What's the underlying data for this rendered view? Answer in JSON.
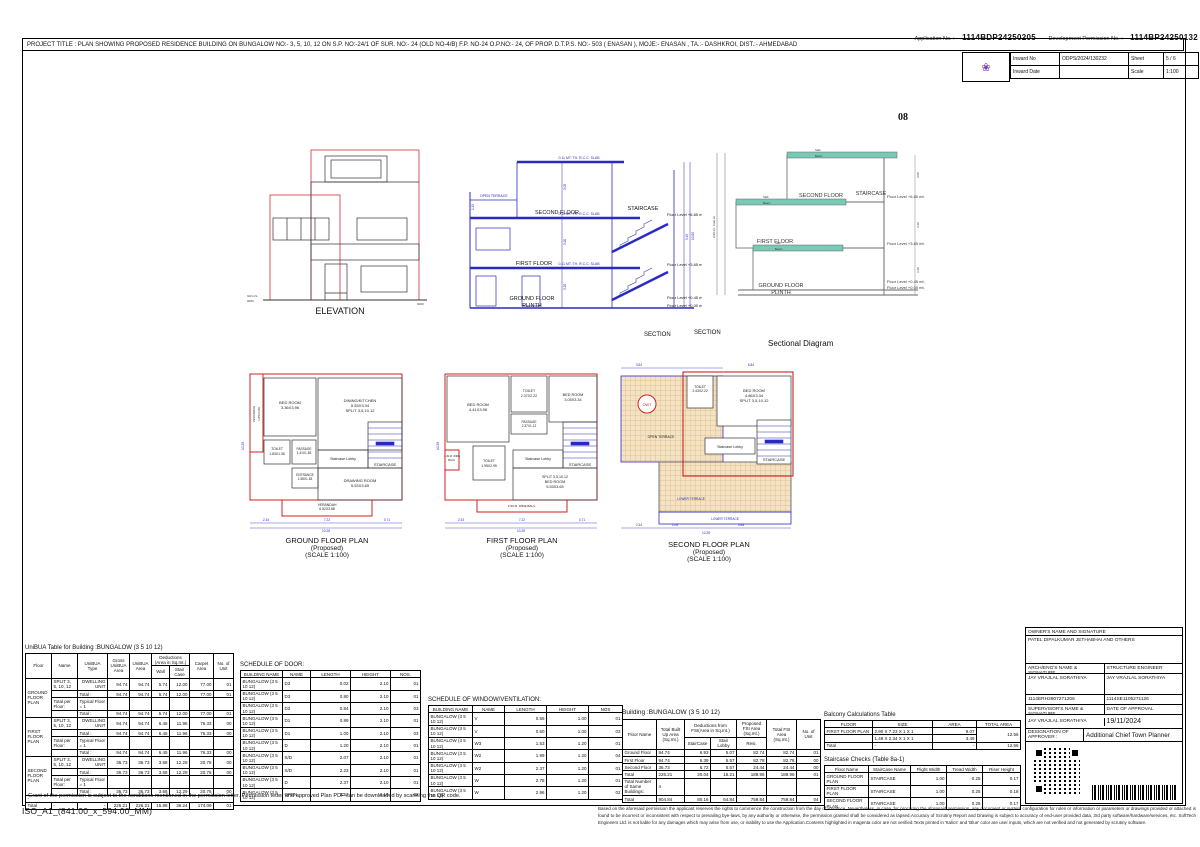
{
  "colors": {
    "plan_red": "#cc2222",
    "cad_blue": "#2a2ac0",
    "slab_teal": "#79c9b6",
    "terrace_tan": "#e7c491",
    "logo_purple": "#7b3fc4"
  },
  "header": {
    "app_no_label": "Application No. :",
    "app_no": "1114BDP24250205",
    "dev_no_label": "Development Permission No. :",
    "dev_no": "1114BP24250132",
    "project_title": "PROJECT TITLE : PLAN SHOWING PROPOSED RESIDENCE BUILDING ON BUNGALOW NO:- 3, 5, 10, 12 ON S.P. NO:-24/1 OF SUR. NO:- 24 (OLD NO-4/B) F.P. NO-24 O.P.NO:- 24, OF PROP. D.T.P.S. NO:- 503 ( ENASAN ), MOJE:- ENASAN , TA.:- DASHKROI, DIST.:- AHMEDABAD",
    "page_no": "08",
    "logo_glyph": "❀",
    "inward": {
      "inward_no_label": "Inward No",
      "inward_no": "ODPS/2024/130232",
      "sheet_label": "Sheet",
      "sheet": "5 / 6",
      "inward_date_label": "Inward Date",
      "inward_date": "",
      "scale_label": "Scale",
      "scale": "1:100"
    }
  },
  "drawings": {
    "elevation": {
      "caption": "ELEVATION",
      "gr_lvl": "GR.LVL.",
      "zero": "0000"
    },
    "section": {
      "caption": "SECTION",
      "slab_note": "0.11 MT. TH. R.C.C. SLAB",
      "open_terrace": "OPEN TERRACE",
      "second_floor": "SECOND FLOOR",
      "staircase": "STAIRCASE",
      "first_floor": "FIRST FLOOR",
      "ground_floor": "GROUND FLOOR",
      "plinth": "PLINTH",
      "lvl_685": "Floor Level +6.85 mt.",
      "lvl_365": "Floor Level +3.65 mt.",
      "lvl_045": "Floor Level +0.45 mt.",
      "lvl_000": "Floor Level +0.00 mt.",
      "dims": [
        "3.05",
        "3.20",
        "3.20",
        "1.15",
        "9.45",
        "10.60"
      ]
    },
    "sectional": {
      "caption_section": "SECTION",
      "caption": "Sectional Diagram",
      "slab": "Slab",
      "beam": "Beam",
      "total_ht": "9.90 mt. Total Ht.",
      "second_floor": "SECOND FLOOR",
      "staircase": "STAIRCASE",
      "first_floor": "FIRST FLOOR",
      "ground_floor": "GROUND FLOOR",
      "plinth": "PLINTH",
      "lvl_685": "Floor Level +6.85 mt.",
      "lvl_365": "Floor Level +3.65 mt.",
      "lvl_045": "Floor Level +0.45 mt.",
      "lvl_000": "Floor Level +0.00 mt.",
      "dims": [
        "3.00",
        "3.20",
        "3.20"
      ]
    }
  },
  "plans": {
    "ground": {
      "caption": [
        "GROUND FLOOR PLAN",
        "(Proposed)",
        "(SCALE 1:100)"
      ],
      "bed1": [
        "BED ROOM",
        "3.36X3.96"
      ],
      "dining": [
        "DINING/KITCHEN",
        "5.53X3.34",
        "SPLIT 3,5,10,12"
      ],
      "verandah_l": [
        "VERANDAH",
        "1.05X3.80"
      ],
      "toilet": [
        "TOILET",
        "1.83X1.38"
      ],
      "passage": [
        "PASSAGE",
        "1.41X1.83"
      ],
      "lobby": "Staircase Lobby",
      "stair": "STAIRCASE",
      "entrance": [
        "ENTRANCE",
        "1.58X1.83"
      ],
      "drawing": [
        "DRAWING ROOM",
        "5.53X3.65"
      ],
      "verandah_b": [
        "VERANDAH",
        "6.52X3.88"
      ],
      "dims": {
        "d1": "2.34",
        "d2": "7.22",
        "d3": "0.71",
        "total": "10.28",
        "left": "10.28"
      }
    },
    "first": {
      "caption": [
        "FIRST FLOOR PLAN",
        "(Proposed)",
        "(SCALE 1:100)"
      ],
      "bed1": [
        "BED ROOM",
        "4.41X3.96"
      ],
      "toilet1": [
        "TOILET",
        "2.37X2.22"
      ],
      "bed2": [
        "BED ROOM",
        "3.05X3.34"
      ],
      "passage": [
        "PASSAGE",
        "2.37X1.12"
      ],
      "lobby": "Staircase Lobby",
      "stair": "STAIRCASE",
      "toilet2": [
        "TOILET",
        "1.95X2.95"
      ],
      "bed3": [
        "SPLIT 3,5,10,12",
        "BED ROOM",
        "5.53X3.65"
      ],
      "balc1": [
        "1.49 M. WIDE",
        "BALC."
      ],
      "balc2": "2.90 M. WIDE BALC.",
      "dims": {
        "d1": "2.34",
        "d2": "7.22",
        "d3": "0.71",
        "total": "10.28",
        "left": "10.28"
      }
    },
    "second": {
      "caption": [
        "SECOND FLOOR PLAN",
        "(Proposed)",
        "(SCALE 1:100)"
      ],
      "toilet": [
        "TOILET",
        "1.43X2.22"
      ],
      "bed": [
        "BED ROOM",
        "4.86X3.34",
        "SPLIT 3,5,10,12"
      ],
      "lobby": "Staircase Lobby",
      "stair": "STAIRCASE",
      "open_terrace": "OPEN TERRACE",
      "lower_terrace": "LOWER TERRACE",
      "owt": "OWT",
      "dims": {
        "t1": "3.54",
        "t2": "6.84",
        "b1": "2.34",
        "b2": "2.06",
        "b3": "5.88",
        "total": "10.28"
      }
    }
  },
  "tables": {
    "unibua": {
      "title": "UniBUA Table for Building :BUNGALOW (3  5  10  12)",
      "rows": [
        [
          {
            "t": "Floor",
            "r": 2,
            "cls": "h"
          },
          {
            "t": "Name",
            "r": 2,
            "cls": "h"
          },
          {
            "t": "UniBUA Type",
            "r": 2,
            "cls": "h"
          },
          {
            "t": "Gross UniBUA Area",
            "r": 2,
            "cls": "h"
          },
          {
            "t": "UniBUA Area",
            "r": 2,
            "cls": "h"
          },
          {
            "t": "Deductions (Area in Sq.mt.)",
            "c": 2,
            "cls": "h"
          },
          {
            "t": "Carpet Area",
            "r": 2,
            "cls": "h"
          },
          {
            "t": "No. of Unit",
            "r": 2,
            "cls": "h"
          }
        ],
        [
          {
            "t": "Wall",
            "cls": "h"
          },
          {
            "t": "Stair Case",
            "cls": "h"
          }
        ],
        [
          {
            "t": "GROUND FLOOR PLAN",
            "r": 4
          },
          "SPLIT 3, 5, 10, 12",
          "DWELLING UNIT",
          "94.74",
          "94.74",
          "5.74",
          "12.00",
          "77.00",
          "01"
        ],
        [
          "",
          "Total :",
          "94.74",
          "94.74",
          "5.74",
          "12.00",
          "77.00",
          "01"
        ],
        [
          "Total per Floor: ",
          "Typical Floor = 1",
          "",
          "",
          "",
          "",
          "",
          ""
        ],
        [
          "",
          "Total :",
          "94.74",
          "94.74",
          "5.74",
          "12.00",
          "77.00",
          "01"
        ],
        [
          {
            "t": "FIRST FLOOR PLAN",
            "r": 4
          },
          "SPLIT 3, 5, 10, 12",
          "DWELLING UNIT",
          "94.74",
          "94.74",
          "6.45",
          "11.96",
          "76.33",
          "00"
        ],
        [
          "",
          "Total :",
          "94.74",
          "94.74",
          "6.45",
          "11.96",
          "76.33",
          "00"
        ],
        [
          "Total per Floor: ",
          "Typical Floor = 1",
          "",
          "",
          "",
          "",
          "",
          ""
        ],
        [
          "",
          "Total :",
          "94.74",
          "94.74",
          "6.45",
          "11.96",
          "76.33",
          "00"
        ],
        [
          {
            "t": "SECOND FLOOR PLAN",
            "r": 4
          },
          "SPLIT 3, 5, 10, 12",
          "DWELLING UNIT",
          "36.73",
          "36.73",
          "3.68",
          "12.29",
          "20.76",
          "00"
        ],
        [
          "",
          "Total :",
          "36.73",
          "36.73",
          "3.68",
          "12.29",
          "20.76",
          "00"
        ],
        [
          "Total per Floor: ",
          "Typical Floor = 1",
          "",
          "",
          "",
          "",
          "",
          ""
        ],
        [
          "",
          "Total :",
          "36.73",
          "36.73",
          "3.68",
          "12.29",
          "20.76",
          "00"
        ],
        [
          {
            "t": "-",
            "c": 9
          }
        ],
        [
          "Total",
          "-",
          "-",
          "226.21",
          "226.21",
          "15.88",
          "36.24",
          "174.09",
          "01"
        ]
      ]
    },
    "door": {
      "title": "SCHEDULE OF DOOR:",
      "rows": [
        [
          {
            "t": "BUILDING NAME",
            "cls": "h"
          },
          {
            "t": "NAME",
            "cls": "h"
          },
          {
            "t": "LENGTH",
            "cls": "h"
          },
          {
            "t": "HEIGHT",
            "cls": "h"
          },
          {
            "t": "NOS.",
            "cls": "h"
          }
        ],
        [
          "BUNGALOW (3 5 10 12)",
          "D3",
          "0.02",
          "2.10",
          "01"
        ],
        [
          "BUNGALOW (3 5 10 12)",
          "D3",
          "0.80",
          "2.10",
          "01"
        ],
        [
          "BUNGALOW (3 5 10 12)",
          "D3",
          "0.84",
          "2.10",
          "03"
        ],
        [
          "BUNGALOW (3 5 10 12)",
          "D1",
          "0.89",
          "2.10",
          "01"
        ],
        [
          "BUNGALOW (3 5 10 12)",
          "D1",
          "1.00",
          "2.10",
          "03"
        ],
        [
          "BUNGALOW (3 5 10 12)",
          "D",
          "1.20",
          "2.10",
          "01"
        ],
        [
          "BUNGALOW (3 5 10 12)",
          "S/D",
          "2.07",
          "2.10",
          "01"
        ],
        [
          "BUNGALOW (3 5 10 12)",
          "S/D",
          "2.23",
          "2.10",
          "01"
        ],
        [
          "BUNGALOW (3 5 10 12)",
          "D",
          "2.37",
          "2.10",
          "01"
        ],
        [
          "BUNGALOW (3 5 10 12)",
          "OPEN",
          "2.53",
          "2.10",
          "02"
        ]
      ]
    },
    "window": {
      "title": "SCHEDULE OF WINDOW/VENTILATION:",
      "rows": [
        [
          {
            "t": "BUILDING NAME",
            "cls": "h"
          },
          {
            "t": "NAME",
            "cls": "h"
          },
          {
            "t": "LENGTH",
            "cls": "h"
          },
          {
            "t": "HEIGHT",
            "cls": "h"
          },
          {
            "t": "NOS",
            "cls": "h"
          }
        ],
        [
          "BUNGALOW (3 5 10 12)",
          "V",
          "0.56",
          "1.00",
          "01"
        ],
        [
          "BUNGALOW (3 5 10 12)",
          "V",
          "0.60",
          "1.00",
          "03"
        ],
        [
          "BUNGALOW (3 5 10 12)",
          "W3",
          "1.53",
          "1.20",
          "01"
        ],
        [
          "BUNGALOW (3 5 10 12)",
          "W2",
          "1.99",
          "1.20",
          "04"
        ],
        [
          "BUNGALOW (3 5 10 12)",
          "W2",
          "2.37",
          "1.20",
          "01"
        ],
        [
          "BUNGALOW (3 5 10 12)",
          "W",
          "2.78",
          "1.20",
          "01"
        ],
        [
          "BUNGALOW (3 5 10 12)",
          "W",
          "2.96",
          "1.20",
          "02"
        ]
      ]
    },
    "building": {
      "title": "Building :BUNGALOW (3  5  10  12)",
      "rows": [
        [
          {
            "t": "Floor Name",
            "r": 2,
            "cls": "h"
          },
          {
            "t": "Total Built Up Area (Sq.mt.)",
            "r": 2,
            "cls": "h"
          },
          {
            "t": "Deductions from FSI(Area in Sq.mt.)",
            "c": 2,
            "cls": "h"
          },
          {
            "t": "Proposed FSI Area (Sq.mt.)",
            "cls": "h"
          },
          {
            "t": "Total FSI Area (Sq.mt.)",
            "r": 2,
            "cls": "h"
          },
          {
            "t": "No. of Unit",
            "r": 2,
            "cls": "h"
          }
        ],
        [
          {
            "t": "StairCase",
            "cls": "h"
          },
          {
            "t": "Stair Lobby",
            "cls": "h"
          },
          {
            "t": "Resi.",
            "cls": "h"
          }
        ],
        [
          "Ground Floor",
          "94.74",
          "6.93",
          "5.07",
          "82.74",
          "82.74",
          "01"
        ],
        [
          "First Floor",
          "94.74",
          "6.39",
          "5.57",
          "82.78",
          "82.78",
          "00"
        ],
        [
          "Second Floor",
          "36.73",
          "6.72",
          "5.57",
          "24.44",
          "24.44",
          "00"
        ],
        [
          "Total",
          "226.21",
          "20.04",
          "16.21",
          "189.96",
          "189.96",
          "01"
        ],
        [
          "Total Number of Same Buildings:",
          "4",
          "",
          "",
          "",
          "",
          ""
        ],
        [
          "Total",
          "904.84",
          "80.16",
          "64.84",
          "759.84",
          "759.84",
          "04"
        ]
      ]
    },
    "balcony": {
      "title": "Balcony Calculations Table",
      "rows": [
        [
          {
            "t": "FLOOR",
            "cls": "h"
          },
          {
            "t": "SIZE",
            "cls": "h"
          },
          {
            "t": "AREA",
            "cls": "h"
          },
          {
            "t": "TOTAL AREA",
            "cls": "h"
          }
        ],
        [
          "FIRST FLOOR PLAN",
          "2.90 X 7.23 X 1 X 1",
          "9.07",
          {
            "t": "12.56",
            "r": 2
          }
        ],
        [
          "",
          "1.49 X 2.34 X 1 X 1",
          "3.49"
        ],
        [
          "Total",
          "-",
          "-",
          "12.56"
        ]
      ]
    },
    "staircase": {
      "title": "Staircase Checks (Table 8a-1)",
      "rows": [
        [
          {
            "t": "Floor Name",
            "cls": "h"
          },
          {
            "t": "StairCase Name",
            "cls": "h"
          },
          {
            "t": "Flight Width",
            "cls": "h"
          },
          {
            "t": "Tread Width",
            "cls": "h"
          },
          {
            "t": "Riser Height",
            "cls": "h"
          }
        ],
        [
          "GROUND FLOOR PLAN",
          "STAIRCASE",
          "1.00",
          "0.25",
          "0.17"
        ],
        [
          "FIRST FLOOR PLAN",
          "STAIRCASE",
          "1.00",
          "0.25",
          "0.18"
        ],
        [
          "SECOND FLOOR PLAN",
          "STAIRCASE",
          "1.00",
          "0.25",
          "0.17"
        ]
      ]
    }
  },
  "signatures": {
    "owner_label": "OWNER'S NAME AND SIGNATURE",
    "owner_name": "PATEL DIPALKUMAR JETHABHAI AND OTHERS",
    "arch_label": "ARCH/ENG'S NAME & SIGNATURE",
    "struct_label": "STRUCTURE ENGINEER",
    "arch_name": "JAY VRAJLAL SORATHIYA",
    "struct_name": "JAY VRAJLAL SORATHIYA",
    "arch_reg": "1114ERH2807271206",
    "struct_reg": "1114SE1105271126",
    "supervisor_label": "SUPERVISOR'S NAME & SIGNATURE",
    "approval_label": "DATE OF APPROVAL",
    "supervisor_name": "JAY VRAJLAL SORATHIYA",
    "approval_date": "19/11/2024",
    "designation_label": "DESIGNATION OF APPROVER :",
    "designation": "Additional Chief Town Planner"
  },
  "footer": {
    "grant_note": "Grant of the permission is subject to the conditions mentioned in the permission letter. Permission letter and approved Plan PDF can be downloaded by scanning the QR code.",
    "paper": "ISO_A1_(841.00_x_594.00_MM)",
    "disclaimer": "Based on the aforesaid permission the applicant reserves the rights to commence the construction from the day of issuance. Nevertheless, in case, for procuring the aforesaid permission, any document or system configuration for rules or information or parameters or drawings provided or attached is found to be incorrect or inconsistent with respect to prevailing bye-laws, by any authority or otherwise, the permission granted shall be considered as lapsed.Accuracy of Scrutiny Report and Drawing is subject to accuracy of end-user provided data, 3rd party software/hardware/services, etc. SoftTech Engineers Ltd. is not liable for any damages which may arise from use, or inability to use the Application.Contents highlighted in magenta color are not verified.Texts printed in 'Italics' and 'Blue' color are user inputs, which are not verified and not generated by scrutiny software."
  }
}
